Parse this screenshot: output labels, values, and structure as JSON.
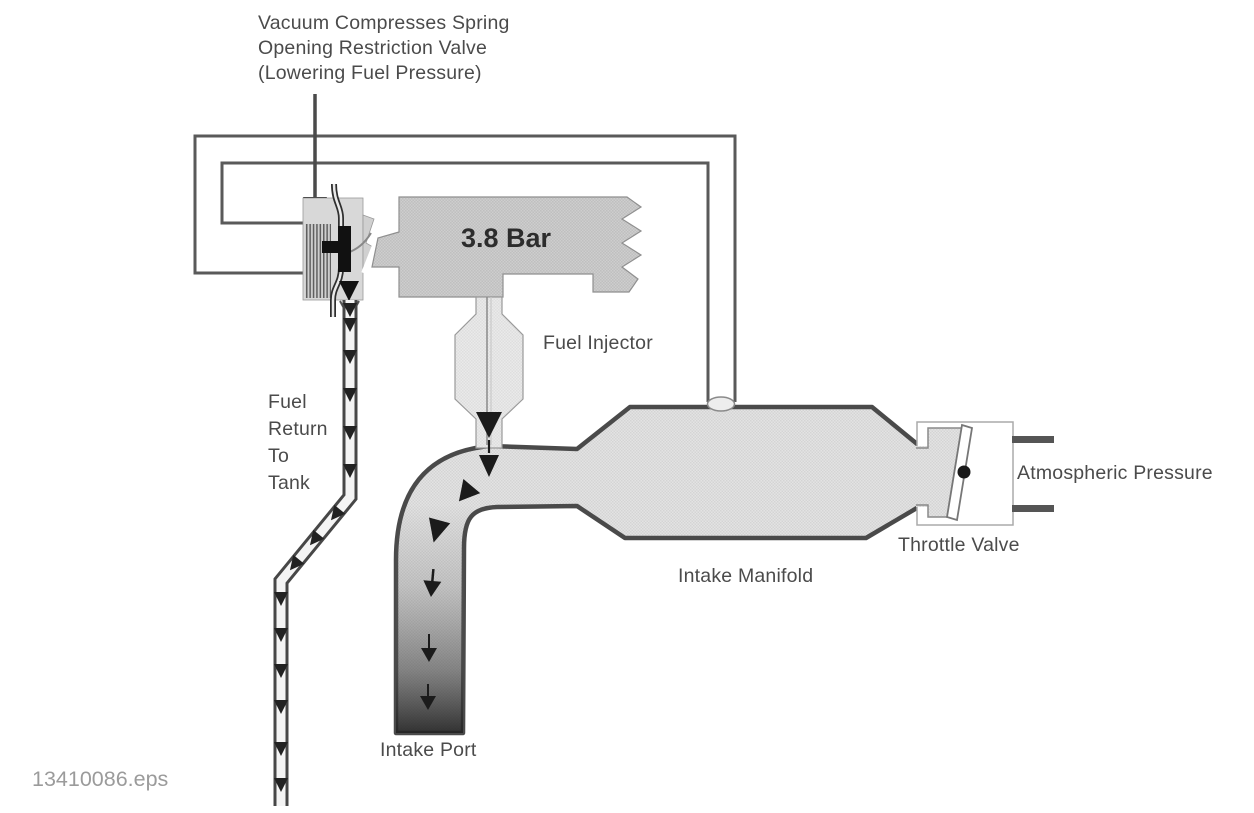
{
  "figure": {
    "filename": "13410086.eps",
    "pressure_value": "3.8 Bar",
    "annotation": {
      "line1": "Vacuum Compresses Spring",
      "line2": "Opening Restriction Valve",
      "line3": "(Lowering Fuel Pressure)"
    },
    "labels": {
      "fuel_injector": "Fuel Injector",
      "fuel_return": [
        "Fuel",
        "Return",
        "To",
        "Tank"
      ],
      "intake_manifold": "Intake Manifold",
      "intake_port": "Intake Port",
      "throttle_valve": "Throttle Valve",
      "atmospheric_pressure": "Atmospheric Pressure"
    },
    "colors": {
      "outline_dark": "#4a4a4a",
      "line_gray": "#5a5a5a",
      "fill_light": "#e2e2e2",
      "fill_block": "#cdcdcd",
      "arrow_black": "#1b1b1b",
      "text_gray": "#4b4b4b",
      "caption_gray": "#9b9b9b"
    }
  }
}
